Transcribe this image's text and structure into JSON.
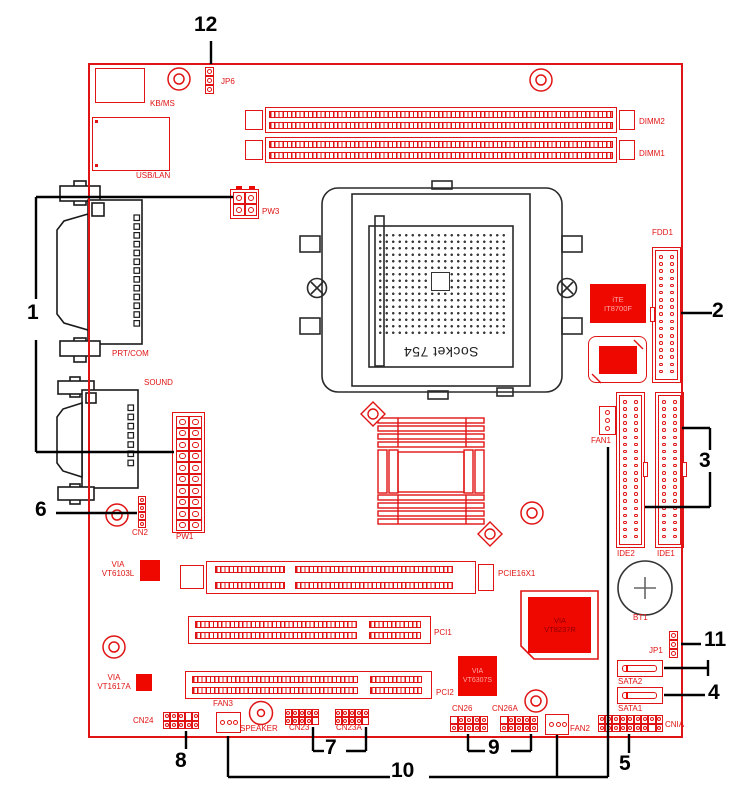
{
  "colors": {
    "red": "#e01414",
    "red_fill": "#ee0800",
    "line_black": "#000000",
    "drawing_black": "#2a2a2a",
    "battery_gray": "#666666",
    "chip_text_light": "#ffa6a6",
    "chip_text_dark": "#8e0000"
  },
  "socket_label": "Socket 754",
  "chips": {
    "ite": {
      "line1": "iTE",
      "line2": "IT8700F"
    },
    "vt8237r": {
      "line1": "VIA",
      "line2": "VT8237R"
    },
    "vt6307s": {
      "line1": "VIA",
      "line2": "VT6307S"
    }
  },
  "labels": [
    {
      "id": "kbms",
      "text": "KB/MS",
      "x": 150,
      "y": 99
    },
    {
      "id": "usblan",
      "text": "USB/LAN",
      "x": 136,
      "y": 171
    },
    {
      "id": "jp6",
      "text": "JP6",
      "x": 221,
      "y": 77
    },
    {
      "id": "pw3",
      "text": "PW3",
      "x": 262,
      "y": 207
    },
    {
      "id": "dimm2",
      "text": "DIMM2",
      "x": 639,
      "y": 117
    },
    {
      "id": "dimm1",
      "text": "DIMM1",
      "x": 639,
      "y": 149
    },
    {
      "id": "prtcom",
      "text": "PRT/COM",
      "x": 112,
      "y": 349
    },
    {
      "id": "sound",
      "text": "SOUND",
      "x": 144,
      "y": 378
    },
    {
      "id": "cn2",
      "text": "CN2",
      "x": 132,
      "y": 528
    },
    {
      "id": "pw1",
      "text": "PW1",
      "x": 176,
      "y": 532
    },
    {
      "id": "fan1",
      "text": "FAN1",
      "x": 591,
      "y": 436
    },
    {
      "id": "fdd1",
      "text": "FDD1",
      "x": 652,
      "y": 228
    },
    {
      "id": "ide2",
      "text": "IDE2",
      "x": 617,
      "y": 549
    },
    {
      "id": "ide1",
      "text": "IDE1",
      "x": 657,
      "y": 549
    },
    {
      "id": "bt1",
      "text": "BT1",
      "x": 633,
      "y": 613
    },
    {
      "id": "jp1",
      "text": "JP1",
      "x": 649,
      "y": 646
    },
    {
      "id": "sata2",
      "text": "SATA2",
      "x": 618,
      "y": 677
    },
    {
      "id": "sata1",
      "text": "SATA1",
      "x": 618,
      "y": 704
    },
    {
      "id": "cnia",
      "text": "CNIA",
      "x": 665,
      "y": 720
    },
    {
      "id": "fan2",
      "text": "FAN2",
      "x": 570,
      "y": 724
    },
    {
      "id": "cn26",
      "text": "CN26",
      "x": 452,
      "y": 704
    },
    {
      "id": "cn26a",
      "text": "CN26A",
      "x": 492,
      "y": 704
    },
    {
      "id": "pcie",
      "text": "PCIE16X1",
      "x": 498,
      "y": 569
    },
    {
      "id": "pci1",
      "text": "PCI1",
      "x": 434,
      "y": 628
    },
    {
      "id": "pci2",
      "text": "PCI2",
      "x": 436,
      "y": 688
    },
    {
      "id": "cn24",
      "text": "CN24",
      "x": 133,
      "y": 716
    },
    {
      "id": "fan3",
      "text": "FAN3",
      "x": 213,
      "y": 699
    },
    {
      "id": "speaker",
      "text": "SPEAKER",
      "x": 240,
      "y": 724
    },
    {
      "id": "cn23",
      "text": "CN23",
      "x": 289,
      "y": 723
    },
    {
      "id": "cn23a",
      "text": "CN23A",
      "x": 336,
      "y": 723
    },
    {
      "id": "via6103",
      "text": "VIA\nVT6103L",
      "x": 98,
      "y": 560,
      "w": 40,
      "align": "center"
    },
    {
      "id": "via1617",
      "text": "VIA\nVT1617A",
      "x": 94,
      "y": 673,
      "w": 40,
      "align": "center"
    }
  ],
  "callout_numbers": [
    {
      "num": "1",
      "x": 27,
      "y": 302
    },
    {
      "num": "2",
      "x": 712,
      "y": 300
    },
    {
      "num": "3",
      "x": 699,
      "y": 450
    },
    {
      "num": "4",
      "x": 708,
      "y": 682
    },
    {
      "num": "5",
      "x": 619,
      "y": 753
    },
    {
      "num": "6",
      "x": 35,
      "y": 499
    },
    {
      "num": "7",
      "x": 325,
      "y": 737
    },
    {
      "num": "8",
      "x": 175,
      "y": 750
    },
    {
      "num": "9",
      "x": 488,
      "y": 737
    },
    {
      "num": "10",
      "x": 391,
      "y": 760
    },
    {
      "num": "11",
      "x": 704,
      "y": 629
    },
    {
      "num": "12",
      "x": 194,
      "y": 14
    }
  ],
  "callout_lines": [
    [
      36,
      197,
      233,
      197
    ],
    [
      36,
      197,
      36,
      299
    ],
    [
      36,
      340,
      36,
      452
    ],
    [
      36,
      452,
      174,
      452
    ],
    [
      681,
      313,
      712,
      313
    ],
    [
      682,
      428,
      710,
      428
    ],
    [
      710,
      428,
      710,
      450
    ],
    [
      710,
      472,
      710,
      507
    ],
    [
      710,
      507,
      645,
      507
    ],
    [
      664,
      668,
      708,
      668
    ],
    [
      708,
      660,
      708,
      676
    ],
    [
      664,
      695,
      705,
      695
    ],
    [
      629,
      734,
      629,
      753
    ],
    [
      56,
      513,
      137,
      513
    ],
    [
      313,
      727,
      313,
      751
    ],
    [
      313,
      751,
      324,
      751
    ],
    [
      346,
      751,
      366,
      751
    ],
    [
      366,
      727,
      366,
      751
    ],
    [
      186,
      731,
      186,
      749
    ],
    [
      468,
      734,
      468,
      751
    ],
    [
      468,
      751,
      485,
      751
    ],
    [
      511,
      751,
      531,
      751
    ],
    [
      531,
      734,
      531,
      751
    ],
    [
      228,
      777,
      390,
      777
    ],
    [
      429,
      777,
      608,
      777
    ],
    [
      228,
      736,
      228,
      777
    ],
    [
      557,
      735,
      557,
      777
    ],
    [
      608,
      447,
      608,
      777
    ],
    [
      681,
      644,
      701,
      644
    ],
    [
      211,
      41,
      211,
      64
    ]
  ],
  "pin_headers": [
    {
      "id": "jp6",
      "x": 205,
      "y": 67,
      "rows": 3,
      "cols": 1,
      "cw": 9,
      "ch": 9
    },
    {
      "id": "jp1",
      "x": 669,
      "y": 631,
      "rows": 3,
      "cols": 1,
      "cw": 9,
      "ch": 9
    },
    {
      "id": "cn2",
      "x": 138,
      "y": 496,
      "rows": 4,
      "cols": 1,
      "cw": 8,
      "ch": 8
    },
    {
      "id": "pw3",
      "x": 233,
      "y": 192,
      "rows": 2,
      "cols": 2,
      "cw": 12,
      "ch": 12,
      "outer": [
        230,
        189,
        29,
        30
      ]
    },
    {
      "id": "pw1",
      "x": 176,
      "y": 416,
      "rows": 10,
      "cols": 2,
      "cw": 13,
      "ch": 11.5,
      "outer": [
        172,
        412,
        33,
        121
      ]
    },
    {
      "id": "cn24",
      "x": 163,
      "y": 712,
      "rows": 2,
      "cols": 5,
      "cw": 7.3,
      "ch": 8.6,
      "missing": [
        [
          0,
          3
        ]
      ]
    },
    {
      "id": "cn23",
      "x": 285,
      "y": 709,
      "rows": 2,
      "cols": 5,
      "cw": 6.8,
      "ch": 8,
      "missing": [
        [
          1,
          4
        ]
      ]
    },
    {
      "id": "cn23a",
      "x": 335,
      "y": 709,
      "rows": 2,
      "cols": 5,
      "cw": 6.8,
      "ch": 8,
      "missing": [
        [
          1,
          4
        ]
      ]
    },
    {
      "id": "cn26",
      "x": 450,
      "y": 716,
      "rows": 2,
      "cols": 5,
      "cw": 7.6,
      "ch": 8.2,
      "missing": [
        [
          0,
          0
        ]
      ]
    },
    {
      "id": "cn26a",
      "x": 500,
      "y": 716,
      "rows": 2,
      "cols": 5,
      "cw": 7.6,
      "ch": 8.2,
      "missing": [
        [
          0,
          0
        ]
      ]
    },
    {
      "id": "cnia",
      "x": 598,
      "y": 715,
      "rows": 2,
      "cols": 9,
      "cw": 7.2,
      "ch": 8.6,
      "missing": [
        [
          1,
          7
        ]
      ]
    }
  ],
  "fan_connectors": [
    {
      "id": "fan1",
      "x": 599,
      "y": 406,
      "w": 17,
      "h": 29,
      "pins": 3,
      "dir": "v"
    },
    {
      "id": "fan3",
      "x": 216,
      "y": 712,
      "w": 25,
      "h": 21,
      "pins": 3,
      "dir": "h"
    },
    {
      "id": "fan2",
      "x": 545,
      "y": 714,
      "w": 24,
      "h": 21,
      "pins": 3,
      "dir": "h"
    }
  ],
  "ribbon_connectors": [
    {
      "id": "fdd1",
      "x": 652,
      "y": 247,
      "w": 29,
      "h": 136,
      "rows": 17,
      "notch": "left"
    },
    {
      "id": "ide2",
      "x": 616,
      "y": 392,
      "w": 29,
      "h": 156,
      "rows": 20,
      "notch": "right"
    },
    {
      "id": "ide1",
      "x": 655,
      "y": 392,
      "w": 29,
      "h": 156,
      "rows": 20,
      "notch": "right"
    }
  ],
  "mount_holes": [
    {
      "cx": 179,
      "cy": 79
    },
    {
      "cx": 541,
      "cy": 80
    },
    {
      "cx": 117,
      "cy": 515
    },
    {
      "cx": 532,
      "cy": 513
    },
    {
      "cx": 114,
      "cy": 647
    },
    {
      "cx": 536,
      "cy": 701
    }
  ],
  "speaker": {
    "cx": 261,
    "cy": 713
  },
  "battery": {
    "cx": 645,
    "cy": 588,
    "r": 27
  }
}
